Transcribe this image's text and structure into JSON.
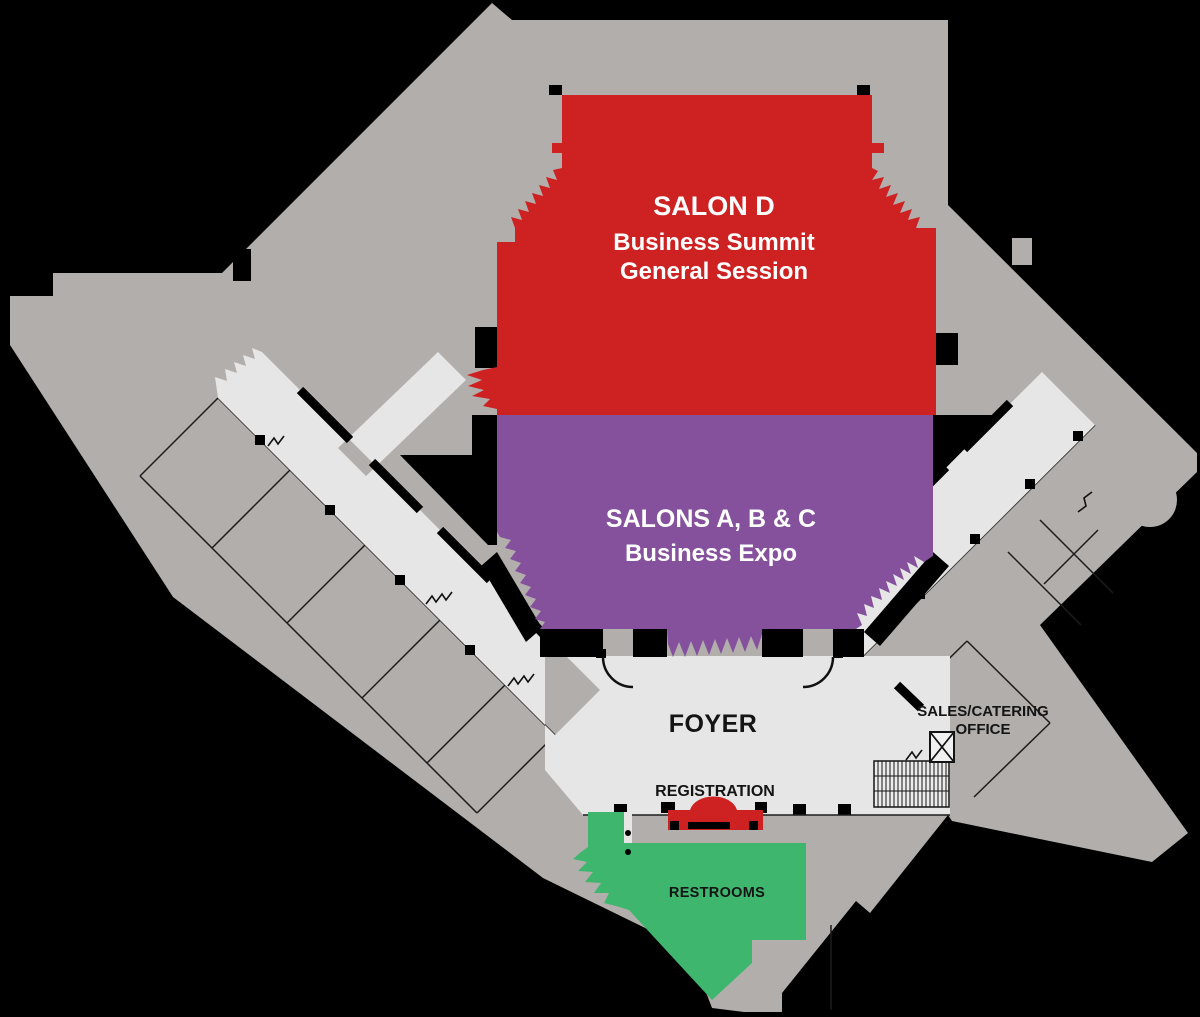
{
  "colors": {
    "background": "#000000",
    "building": "#B2AEAC",
    "foyer": "#E6E6E6",
    "salon_d": "#CE2121",
    "salons_abc": "#85519C",
    "restrooms": "#3FB66E",
    "registration_desk": "#CE2121",
    "stairs_fill": "#ECECEC",
    "elevator_fill": "#F1F1F1",
    "label_light": "#FFFFFF",
    "label_dark": "#141414"
  },
  "rooms": {
    "salon_d": {
      "name": "SALON D",
      "event_line1": "Business Summit",
      "event_line2": "General Session"
    },
    "salons_abc": {
      "name": "SALONS A, B & C",
      "event_line1": "Business Expo"
    },
    "foyer": {
      "name": "FOYER"
    },
    "registration": {
      "name": "REGISTRATION"
    },
    "sales_office": {
      "name_line1": "SALES/CATERING",
      "name_line2": "OFFICE"
    },
    "restrooms": {
      "name": "RESTROOMS"
    }
  }
}
